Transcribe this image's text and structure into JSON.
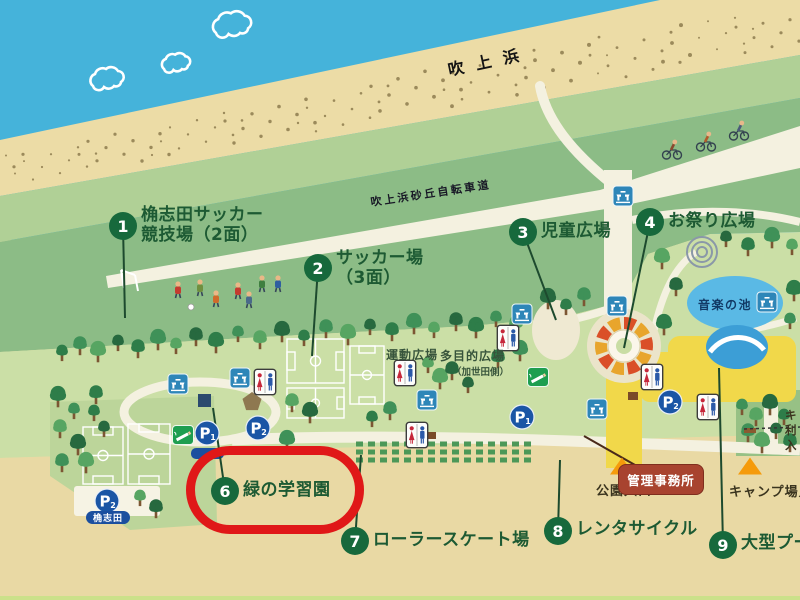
{
  "map": {
    "highlight_color": "#e01818",
    "spot_circle_color": "#17693c",
    "spots": [
      {
        "number": "1",
        "label": "桷志田サッカー\n競技場（2面）",
        "cx": 123,
        "cy": 226,
        "tx": 141,
        "ty": 205,
        "lx": 125,
        "ly": 318,
        "highlighted": false
      },
      {
        "number": "2",
        "label": "サッカー場\n（3面）",
        "cx": 318,
        "cy": 268,
        "tx": 336,
        "ty": 248,
        "lx": 312,
        "ly": 356,
        "highlighted": false
      },
      {
        "number": "3",
        "label": "児童広場",
        "cx": 523,
        "cy": 232,
        "tx": 541,
        "ty": 221,
        "lx": 556,
        "ly": 320,
        "highlighted": false
      },
      {
        "number": "4",
        "label": "お祭り広場",
        "cx": 650,
        "cy": 222,
        "tx": 668,
        "ty": 211,
        "lx": 624,
        "ly": 348,
        "highlighted": false
      },
      {
        "number": "6",
        "label": "緑の学習園",
        "cx": 225,
        "cy": 491,
        "tx": 243,
        "ty": 480,
        "lx": 213,
        "ly": 408,
        "highlighted": true
      },
      {
        "number": "7",
        "label": "ローラースケート場",
        "cx": 355,
        "cy": 541,
        "tx": 373,
        "ty": 530,
        "lx": 361,
        "ly": 455,
        "highlighted": false
      },
      {
        "number": "8",
        "label": "レンタサイクル",
        "cx": 558,
        "cy": 531,
        "tx": 576,
        "ty": 519,
        "lx": 560,
        "ly": 460,
        "highlighted": false
      },
      {
        "number": "9",
        "label": "大型プール",
        "cx": 723,
        "cy": 545,
        "tx": 741,
        "ty": 533,
        "lx": 719,
        "ly": 368,
        "highlighted": false
      }
    ],
    "region_labels": {
      "sea_name": "吹上浜",
      "bike_path": "吹上浜砂丘自転車道",
      "sports_plaza": "運動広場",
      "multipurpose_plaza": "多目的広場",
      "multipurpose_note": "（加世田側）",
      "music_pond": "音楽の池",
      "park_entrance": "公園入口",
      "admin_office": "管理事務所",
      "camp_entrance": "キャンプ場入口",
      "camp_user_entrance": "キ\n利\n入",
      "parking_name": "桷志田"
    },
    "markers": [
      {
        "icon": "toilet-icon",
        "x": 265,
        "y": 382
      },
      {
        "icon": "toilet-icon",
        "x": 405,
        "y": 373
      },
      {
        "icon": "toilet-icon",
        "x": 417,
        "y": 435
      },
      {
        "icon": "toilet-icon",
        "x": 508,
        "y": 338
      },
      {
        "icon": "toilet-icon",
        "x": 652,
        "y": 377
      },
      {
        "icon": "toilet-icon",
        "x": 708,
        "y": 407
      },
      {
        "icon": "fountain-icon",
        "x": 178,
        "y": 384
      },
      {
        "icon": "fountain-icon",
        "x": 240,
        "y": 378
      },
      {
        "icon": "fountain-icon",
        "x": 427,
        "y": 400
      },
      {
        "icon": "fountain-icon",
        "x": 522,
        "y": 314
      },
      {
        "icon": "fountain-icon",
        "x": 597,
        "y": 409
      },
      {
        "icon": "fountain-icon",
        "x": 617,
        "y": 306
      },
      {
        "icon": "fountain-icon",
        "x": 623,
        "y": 196
      },
      {
        "icon": "fountain-icon",
        "x": 767,
        "y": 302
      },
      {
        "icon": "smoking-area-icon",
        "x": 538,
        "y": 377
      },
      {
        "icon": "smoking-area-icon",
        "x": 183,
        "y": 435
      },
      {
        "icon": "parking-icon",
        "x": 207,
        "y": 433,
        "sub": "1"
      },
      {
        "icon": "parking-icon",
        "x": 258,
        "y": 428,
        "sub": "2"
      },
      {
        "icon": "parking-icon",
        "x": 107,
        "y": 501,
        "sub": "2"
      },
      {
        "icon": "parking-icon",
        "x": 522,
        "y": 417,
        "sub": "1"
      },
      {
        "icon": "parking-icon",
        "x": 670,
        "y": 402,
        "sub": "2"
      },
      {
        "icon": "entrance-triangle-icon",
        "x": 622,
        "y": 466
      },
      {
        "icon": "entrance-triangle-icon",
        "x": 750,
        "y": 466
      }
    ]
  }
}
